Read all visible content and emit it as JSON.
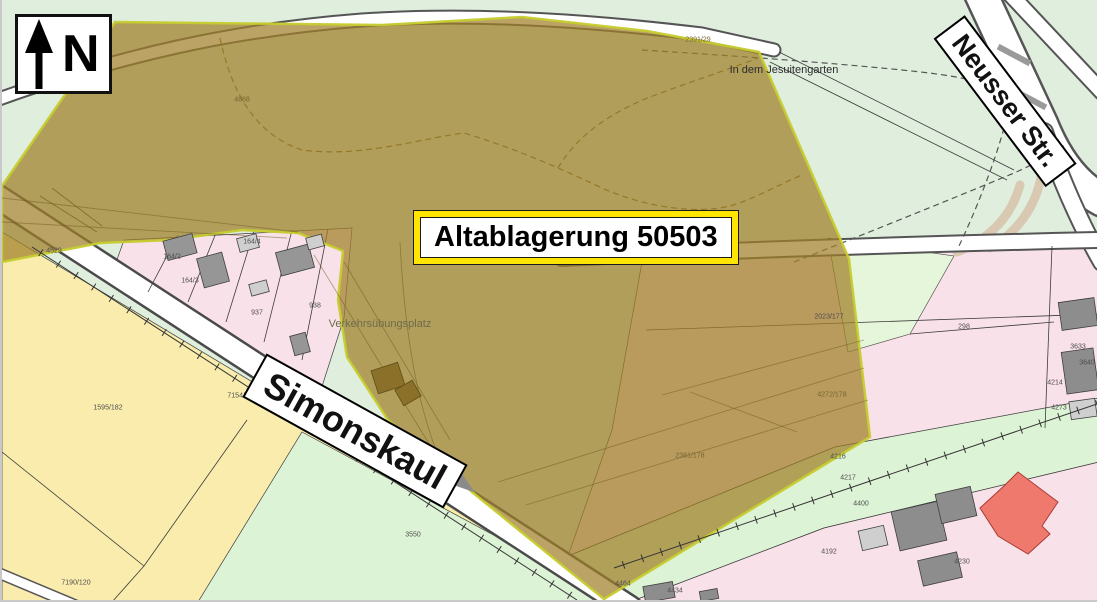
{
  "map": {
    "north_label": "N",
    "site_label": "Altablagerung 50503",
    "street_labels": {
      "neusser": "Neusser Str.",
      "simonskaul": "Simonskaul"
    },
    "place_names": [
      {
        "text": "In dem Jesuitengarten",
        "x": 782,
        "y": 70,
        "cls": "place"
      },
      {
        "text": "Verkehrsübungsplatz",
        "x": 378,
        "y": 324,
        "cls": "place dim-olive"
      },
      {
        "text": "Simonskaul",
        "x": 286,
        "y": 392,
        "cls": "street-small",
        "rot": 33
      }
    ],
    "parcel_numbers": [
      {
        "text": "4888",
        "x": 240,
        "y": 100,
        "dim": true
      },
      {
        "text": "2391/29",
        "x": 696,
        "y": 40,
        "dim": true
      },
      {
        "text": "164/2",
        "x": 170,
        "y": 257
      },
      {
        "text": "164/3",
        "x": 188,
        "y": 281
      },
      {
        "text": "164/4",
        "x": 250,
        "y": 242
      },
      {
        "text": "937",
        "x": 255,
        "y": 313
      },
      {
        "text": "938",
        "x": 313,
        "y": 306
      },
      {
        "text": "4529",
        "x": 52,
        "y": 251
      },
      {
        "text": "1595/182",
        "x": 106,
        "y": 408
      },
      {
        "text": "7154/180",
        "x": 240,
        "y": 396
      },
      {
        "text": "7190/120",
        "x": 74,
        "y": 583
      },
      {
        "text": "3550",
        "x": 411,
        "y": 535
      },
      {
        "text": "298",
        "x": 962,
        "y": 327
      },
      {
        "text": "2023/177",
        "x": 827,
        "y": 317
      },
      {
        "text": "4272/178",
        "x": 830,
        "y": 395,
        "dim": true
      },
      {
        "text": "2381/178",
        "x": 688,
        "y": 456,
        "dim": true
      },
      {
        "text": "3633",
        "x": 1076,
        "y": 347
      },
      {
        "text": "3640",
        "x": 1085,
        "y": 363
      },
      {
        "text": "4214",
        "x": 1053,
        "y": 383
      },
      {
        "text": "4273",
        "x": 1057,
        "y": 408
      },
      {
        "text": "4216",
        "x": 836,
        "y": 457
      },
      {
        "text": "4217",
        "x": 846,
        "y": 478
      },
      {
        "text": "4400",
        "x": 859,
        "y": 504
      },
      {
        "text": "4192",
        "x": 827,
        "y": 552
      },
      {
        "text": "4230",
        "x": 960,
        "y": 562
      },
      {
        "text": "4464",
        "x": 621,
        "y": 584
      },
      {
        "text": "4434",
        "x": 673,
        "y": 591
      }
    ],
    "colors": {
      "overlay_fill": "#a07f28",
      "overlay_border": "#c6cc2f",
      "residential": "#f9e1e9",
      "meadow": "#dfeedd",
      "meadow_light": "#e6f6da",
      "field": "#f9ecac",
      "green_strip": "#ddf3d5",
      "highlight_building": "#f0796e",
      "label_border": "#ffe500"
    }
  }
}
